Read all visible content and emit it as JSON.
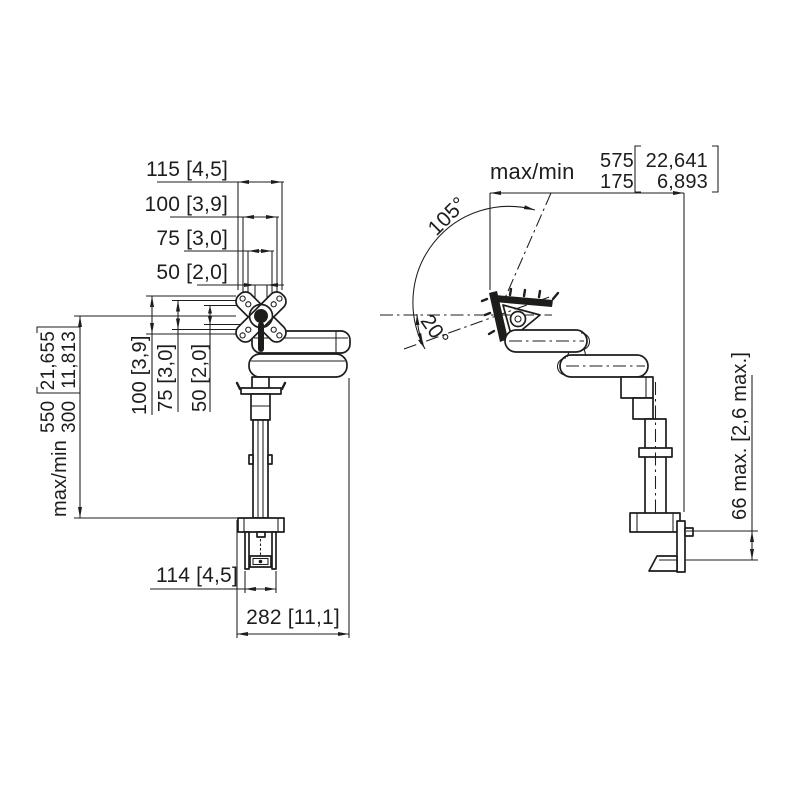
{
  "colors": {
    "background": "#ffffff",
    "line": "#1d1d1b"
  },
  "front_view": {
    "dim_width_115": "115 [4,5]",
    "dim_width_100": "100 [3,9]",
    "dim_width_75": "75 [3,0]",
    "dim_width_50": "50 [2,0]",
    "dim_height_100": "100 [3,9]",
    "dim_height_75": "75 [3,0]",
    "dim_height_50": "50 [2,0]",
    "height_range": {
      "prefix": "max/min",
      "max_mm": "550",
      "min_mm": "300",
      "max_in": "21,655",
      "min_in": "11,813"
    },
    "dim_clamp_width": "114 [4,5]",
    "dim_total_width": "282 [11,1]"
  },
  "side_view": {
    "reach_range": {
      "prefix": "max/min",
      "max_mm": "575",
      "min_mm": "175",
      "max_in": "22,641",
      "min_in": "6,893"
    },
    "angle_up": "105°",
    "angle_down": "20°",
    "dim_desk_thickness": "66 max. [2,6 max.]"
  }
}
